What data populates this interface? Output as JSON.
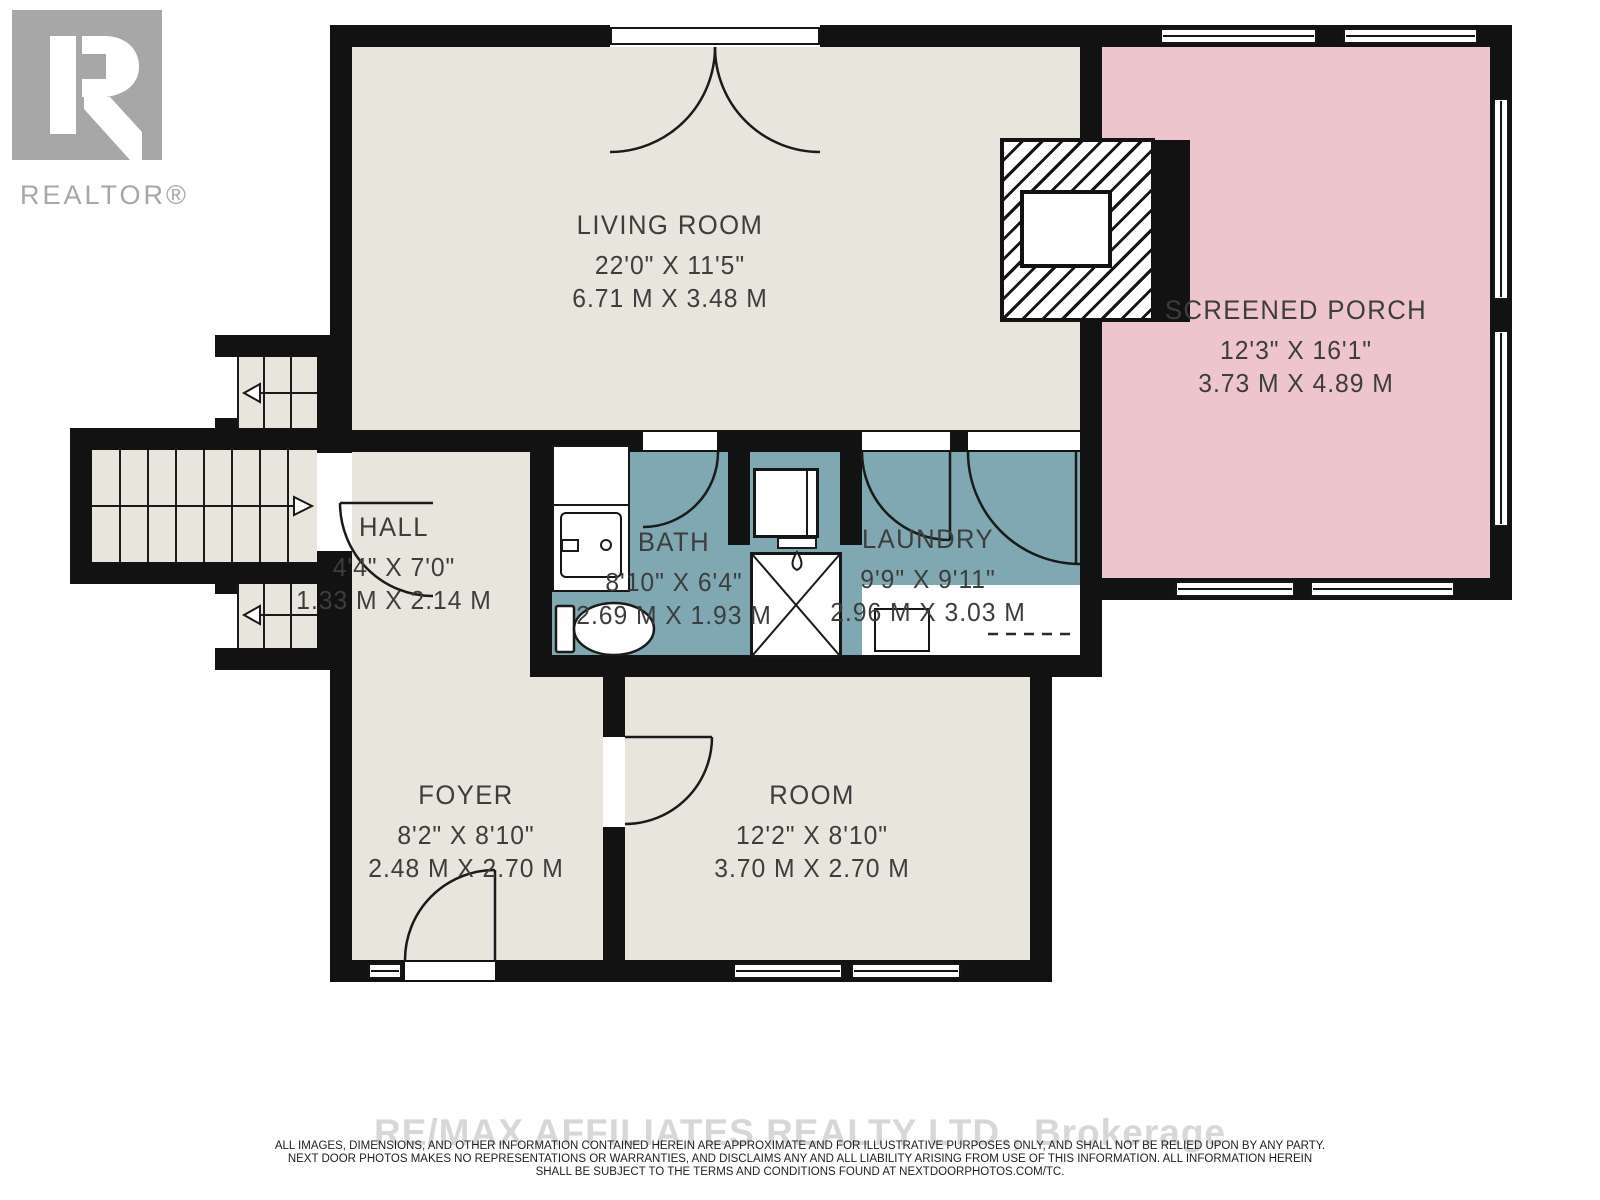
{
  "branding": {
    "logo_letter": "R",
    "logo_text": "REALTOR®"
  },
  "rooms": {
    "living_room": {
      "name": "LIVING ROOM",
      "imperial": "22'0\" X 11'5\"",
      "metric": "6.71 M X 3.48 M"
    },
    "screened_porch": {
      "name": "SCREENED PORCH",
      "imperial": "12'3\" X 16'1\"",
      "metric": "3.73 M X 4.89 M"
    },
    "hall": {
      "name": "HALL",
      "imperial": "4'4\" X 7'0\"",
      "metric": "1.33 M X 2.14 M"
    },
    "bath": {
      "name": "BATH",
      "imperial": "8'10\" X 6'4\"",
      "metric": "2.69 M X 1.93 M"
    },
    "laundry": {
      "name": "LAUNDRY",
      "imperial": "9'9\" X 9'11\"",
      "metric": "2.96 M X 3.03 M"
    },
    "foyer": {
      "name": "FOYER",
      "imperial": "8'2\" X 8'10\"",
      "metric": "2.48 M X 2.70 M"
    },
    "room": {
      "name": "ROOM",
      "imperial": "12'2\" X 8'10\"",
      "metric": "3.70 M X 2.70 M"
    }
  },
  "footer": {
    "watermark": "RE/MAX AFFILIATES REALTY LTD., Brokerage",
    "disclaimer_line1": "ALL IMAGES, DIMENSIONS, AND OTHER INFORMATION CONTAINED HEREIN ARE APPROXIMATE AND FOR ILLUSTRATIVE PURPOSES ONLY, AND SHALL NOT BE RELIED UPON BY ANY PARTY.",
    "disclaimer_line2": "NEXT DOOR PHOTOS MAKES NO REPRESENTATIONS OR WARRANTIES, AND DISCLAIMS ANY AND ALL LIABILITY ARISING FROM USE OF THIS INFORMATION. ALL INFORMATION HEREIN",
    "disclaimer_line3": "SHALL BE SUBJECT TO THE TERMS AND CONDITIONS FOUND AT NEXTDOORPHOTOS.COM/TC."
  },
  "colors": {
    "room_fill": "#e7e5dc",
    "wet_room_fill": "#7fa8b2",
    "porch_fill": "#eec5cc",
    "wall": "#121212",
    "label_text": "#3d3d3d",
    "watermark_gray": "#d7d7d7",
    "logo_gray": "#a7a7a7"
  }
}
